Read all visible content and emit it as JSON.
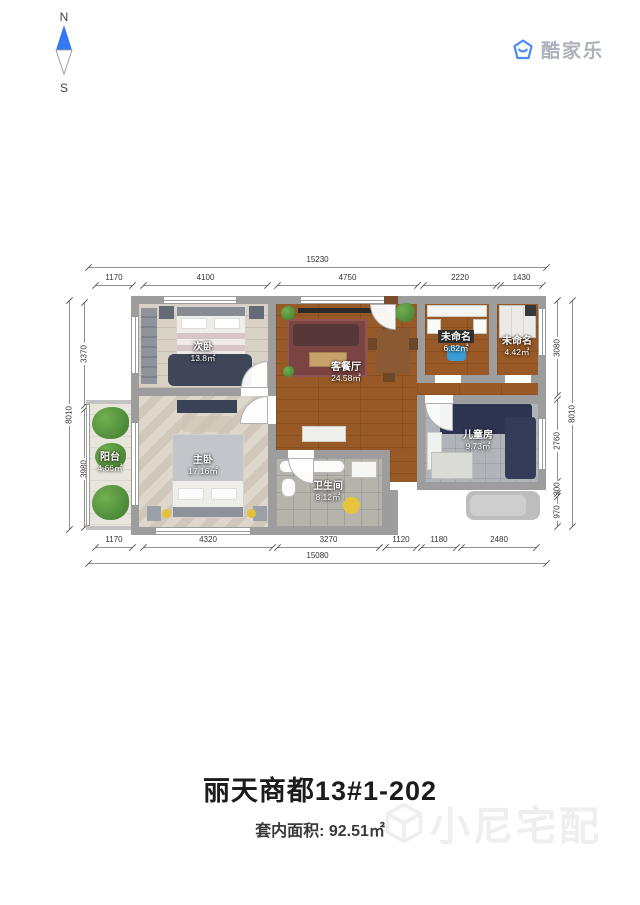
{
  "compass": {
    "north": "N",
    "south": "S"
  },
  "logo": {
    "brand": "酷家乐"
  },
  "watermark": {
    "brand": "小尼宅配"
  },
  "footer": {
    "title": "丽天商都13#1-202",
    "area_line": "套内面积: 92.51㎡"
  },
  "plan": {
    "rooms": [
      {
        "name": "次卧",
        "area": "13.8㎡"
      },
      {
        "name": "客餐厅",
        "area": "24.58㎡"
      },
      {
        "name": "未命名",
        "area": "6.82㎡"
      },
      {
        "name": "未命名",
        "area": "4.42㎡"
      },
      {
        "name": "阳台",
        "area": "4.66㎡"
      },
      {
        "name": "主卧",
        "area": "17.16㎡"
      },
      {
        "name": "卫生间",
        "area": "8.12㎡"
      },
      {
        "name": "儿童房",
        "area": "9.73㎡"
      }
    ],
    "dimensions": {
      "top_total": "15230",
      "top_segments": [
        "1170",
        "4100",
        "4750",
        "2220",
        "1430"
      ],
      "bottom_segments": [
        "1170",
        "4320",
        "3270",
        "1120",
        "1180",
        "2480"
      ],
      "bottom_total": "15080",
      "left_total": "8010",
      "left_segments": [
        "3370",
        "3980"
      ],
      "right_segments": [
        "3080",
        "2760",
        "300",
        "970"
      ],
      "right_total": "8010"
    }
  },
  "colors": {
    "accent_blue": "#3478f6",
    "wall_gray": "#9d9d9d",
    "wood_floor": "#c59763",
    "logo_gray": "#adb2ba",
    "watermark_gray": "#efeff0"
  }
}
